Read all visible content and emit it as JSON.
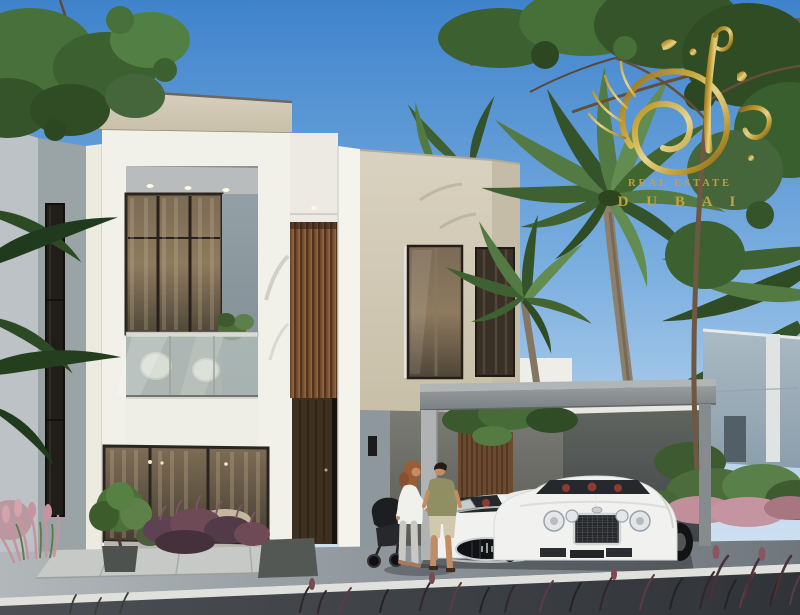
{
  "watermark": {
    "line1": "REAL ESTATE",
    "line2": "D U B A I"
  },
  "palette": {
    "sky_top": "#4285cd",
    "sky_horizon": "#d6e7f4",
    "villa_white": "#f1f0e9",
    "villa_beige": "#d3cab6",
    "villa_gray": "#9aa3a6",
    "wood_slat": "#7a5233",
    "door_wood": "#3e3020",
    "glass_warm": "#6d5f4a",
    "canopy_gray": "#8f9496",
    "dark_wall": "#4a4e4c",
    "background_building": "#9cadb9",
    "palm_green": "#527a42",
    "tree_green": "#35542a",
    "gold": "#c9a233",
    "car_white": "#f1f2ef",
    "car_interior_red": "#8d3a31",
    "road": "#3c4044",
    "pavement": "#9aa1a6",
    "curb_white": "#e0e1dc",
    "plant_pink": "#c08f9a",
    "plant_purple": "#5e4152",
    "skin": "#c38c63",
    "shirt_olive": "#8f8f63"
  }
}
